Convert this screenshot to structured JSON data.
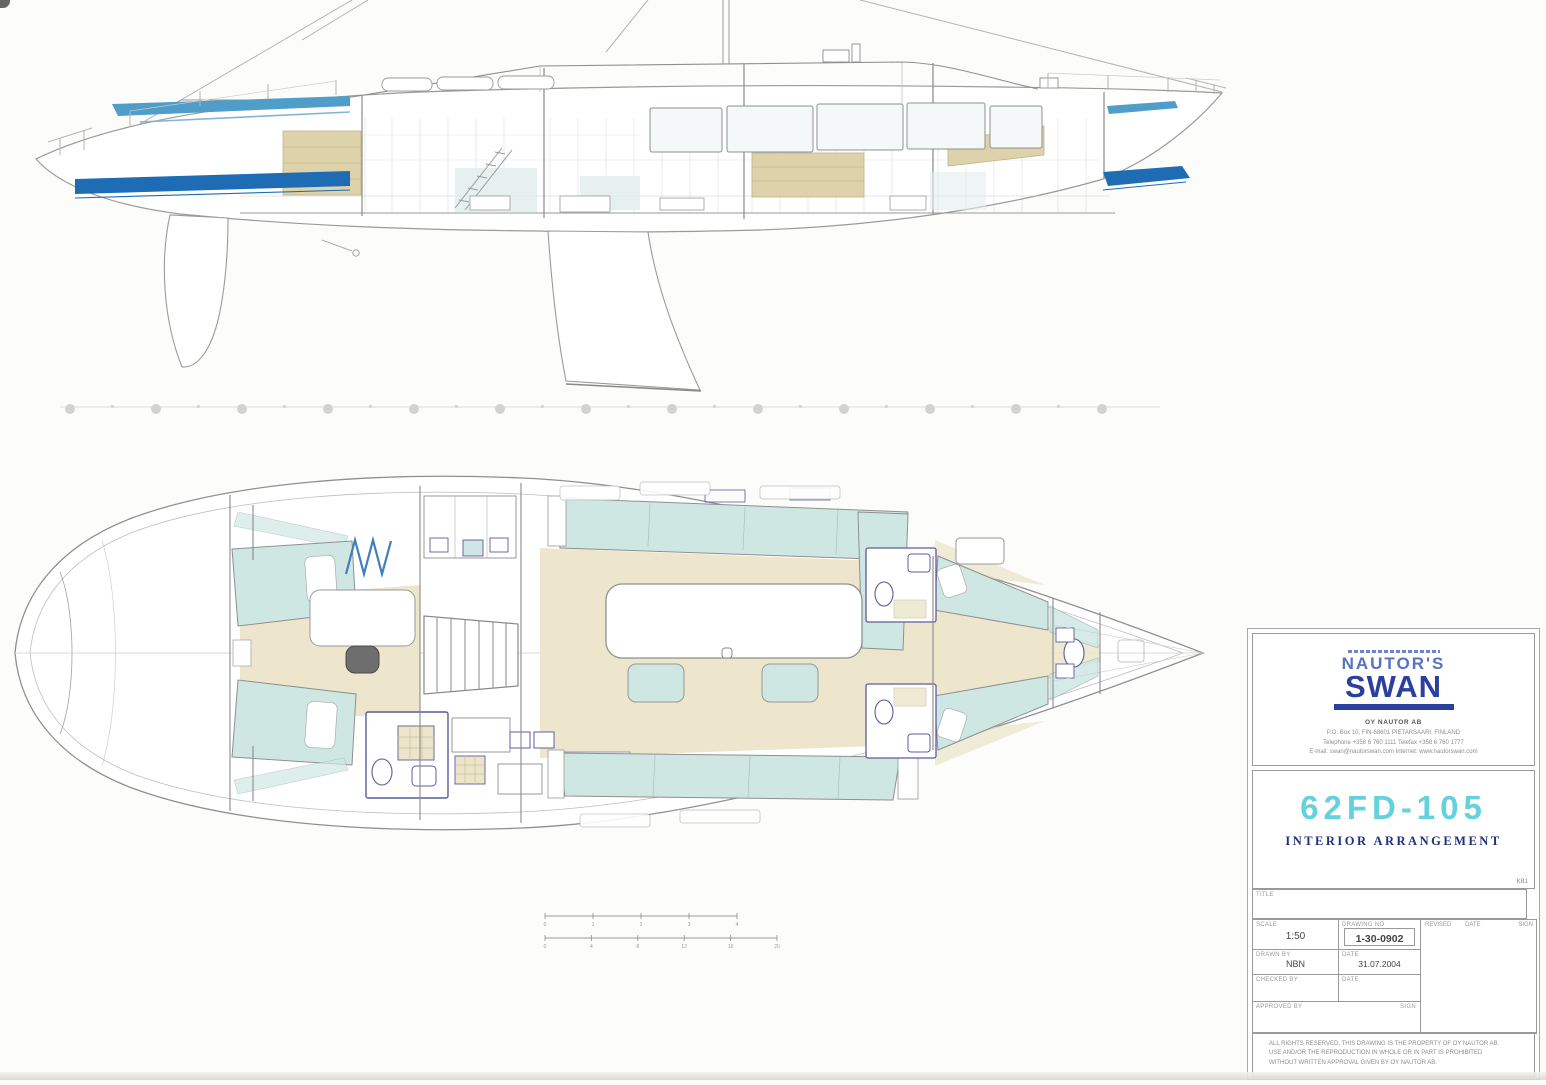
{
  "title_block": {
    "brand": {
      "name_top": "NAUTOR'S",
      "name_main": "SWAN"
    },
    "company_name": "OY NAUTOR AB",
    "address_lines": [
      "P.O. Box 10, FIN-68601 PIETARSAARI, FINLAND",
      "Telephone +358 6 760 1111   Telefax +358 6 760 1777",
      "E-mail: swan@nautorswan.com   Internet: www.nautorswan.com"
    ],
    "model_code": "62FD-105",
    "drawing_title": "INTERIOR ARRANGEMENT",
    "key_ref": "KB1",
    "title_field_label": "TITLE",
    "fields": {
      "scale_label": "SCALE",
      "scale_value": "1:50",
      "drawing_no_label": "DRAWING NO",
      "drawing_no_value": "1-30-0902",
      "revised_label": "REVISED",
      "revised_date_label": "DATE",
      "sign_label": "SIGN",
      "drawn_label": "DRAWN BY",
      "drawn_value": "NBN",
      "date_label": "DATE",
      "date_value": "31.07.2004",
      "checked_label": "CHECKED BY",
      "checked_value": "",
      "checked_date_label": "DATE",
      "checked_date_value": "",
      "approved_label": "APPROVED BY",
      "approved_sign_label": "SIGN"
    },
    "copyright_lines": [
      "ALL RIGHTS RESERVED. THIS DRAWING IS THE PROPERTY OF OY NAUTOR AB.",
      "USE AND/OR THE REPRODUCTION IN WHOLE OR IN PART IS PROHIBITED",
      "WITHOUT WRITTEN APPROVAL GIVEN BY OY NAUTOR AB."
    ]
  },
  "scale_bars": {
    "top_ticks": [
      "0",
      "1",
      "2",
      "3",
      "4"
    ],
    "bottom_ticks": [
      "0",
      "4",
      "8",
      "12",
      "16",
      "20"
    ]
  },
  "colors": {
    "boot_stripe_blue": "#1d6cb4",
    "sheer_stripe_teal": "#4e9ec9",
    "logo_blue": "#2b3f9e",
    "logo_blue_light": "#5673bf",
    "model_cyan": "#63d2dc",
    "title_navy": "#20307c",
    "plan_cushion_teal": "#cfe7e3",
    "plan_sole_tan": "#ece5c9",
    "fixture_navy": "#5c5c9b",
    "seat_gray": "#6e6e6e",
    "line_gray": "#8f8f8f"
  }
}
